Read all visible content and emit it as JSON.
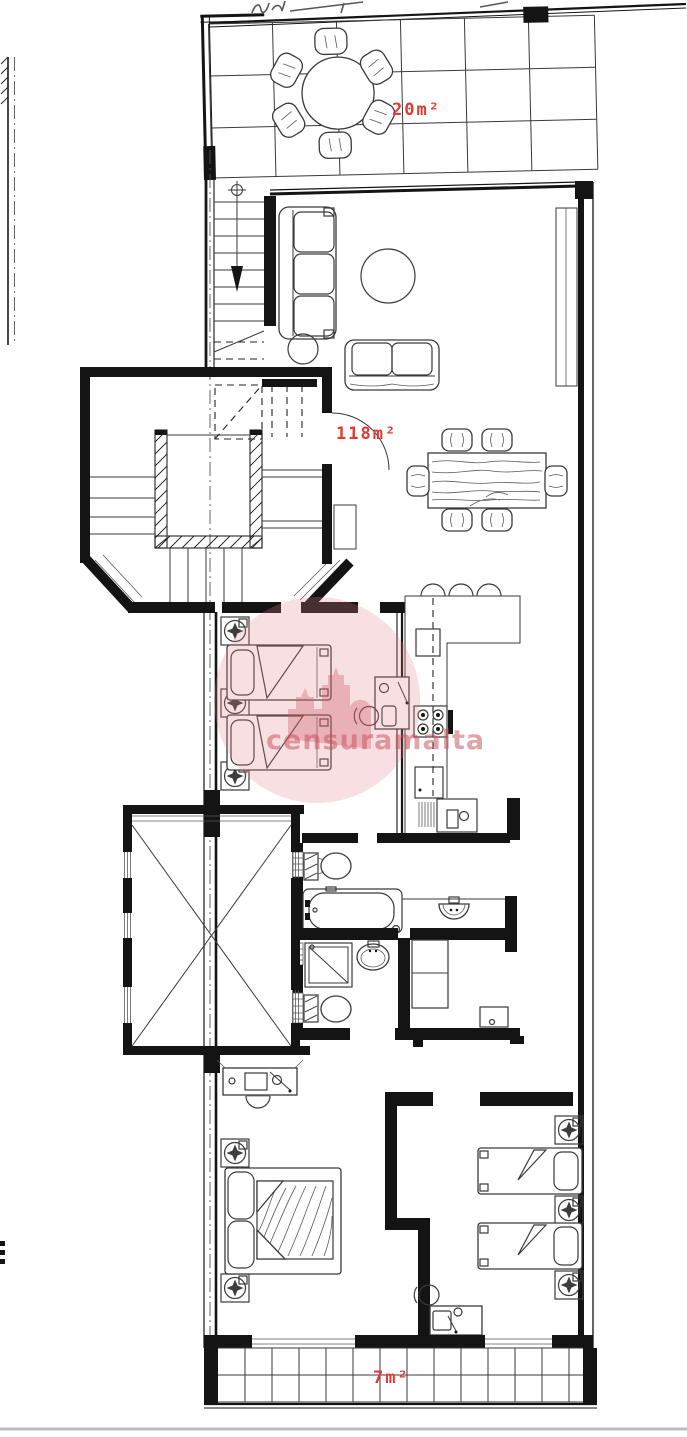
{
  "page": {
    "width": 687,
    "height": 1437,
    "background": "#ffffff"
  },
  "plan": {
    "kind": "residential floor plan drawing",
    "accent_red": "#df3a35",
    "line_color": "#141414",
    "area_labels": [
      {
        "room": "roof-terrace",
        "text": "20m²"
      },
      {
        "room": "internal-floor",
        "text": "118m²"
      },
      {
        "room": "rear-balcony",
        "text": "7m²"
      }
    ]
  },
  "watermark": {
    "text": "censuramalta",
    "tint": "rgba(198,80,90,0.52)"
  }
}
